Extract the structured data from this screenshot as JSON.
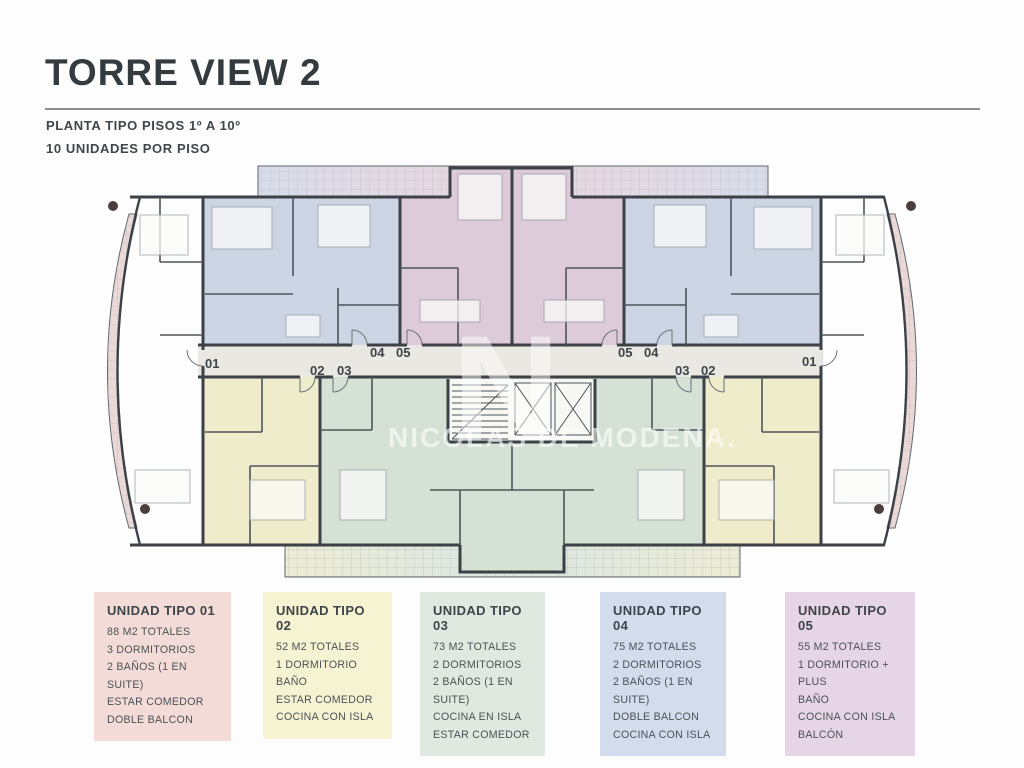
{
  "header": {
    "title": "TORRE VIEW 2",
    "plan_type": "PLANTA TIPO PISOS 1º A 10º",
    "units_per_floor": "10 UNIDADES POR PISO"
  },
  "plan": {
    "watermark": {
      "initial": "N",
      "name": "NICOLAS DE MODENA."
    },
    "corridor_labels": {
      "left": [
        "01",
        "02",
        "03",
        "04",
        "05"
      ],
      "right": [
        "05",
        "04",
        "03",
        "02",
        "01"
      ]
    }
  },
  "legend": [
    {
      "id": "01",
      "title": "UNIDAD TIPO 01",
      "items": [
        "88 M2 TOTALES",
        "3 DORMITORIOS",
        "2 BAÑOS (1 EN SUITE)",
        "ESTAR COMEDOR",
        "DOBLE BALCON"
      ]
    },
    {
      "id": "02",
      "title": "UNIDAD TIPO 02",
      "items": [
        "52 M2 TOTALES",
        "1 DORMITORIO",
        "BAÑO",
        "ESTAR COMEDOR",
        "COCINA CON ISLA"
      ]
    },
    {
      "id": "03",
      "title": "UNIDAD TIPO 03",
      "items": [
        "73 M2 TOTALES",
        "2 DORMITORIOS",
        "2 BAÑOS (1 EN SUITE)",
        "COCINA EN ISLA",
        "ESTAR COMEDOR"
      ]
    },
    {
      "id": "04",
      "title": "UNIDAD TIPO 04",
      "items": [
        "75 M2 TOTALES",
        "2 DORMITORIOS",
        "2 BAÑOS (1 EN SUITE)",
        "DOBLE BALCON",
        "COCINA CON ISLA"
      ]
    },
    {
      "id": "05",
      "title": "UNIDAD TIPO 05",
      "items": [
        "55 M2 TOTALES",
        "1 DORMITORIO + PLUS",
        "BAÑO",
        "COCINA CON ISLA",
        "BALCÓN"
      ]
    }
  ],
  "colors": {
    "unit01": "#ecd3cf",
    "unit02": "#efeccb",
    "unit03": "#d6e1d5",
    "unit04": "#cdd5e4",
    "unit05": "#ddcbd9",
    "legend01": "#f3dbd7",
    "legend02": "#f6f3d3",
    "legend03": "#dfe9df",
    "legend04": "#d2dcec",
    "legend05": "#e6d6e5",
    "corridor": "#e9e8e2",
    "wall": "#3b4147",
    "text": "#343b3f",
    "rule": "#8e8e8e"
  }
}
